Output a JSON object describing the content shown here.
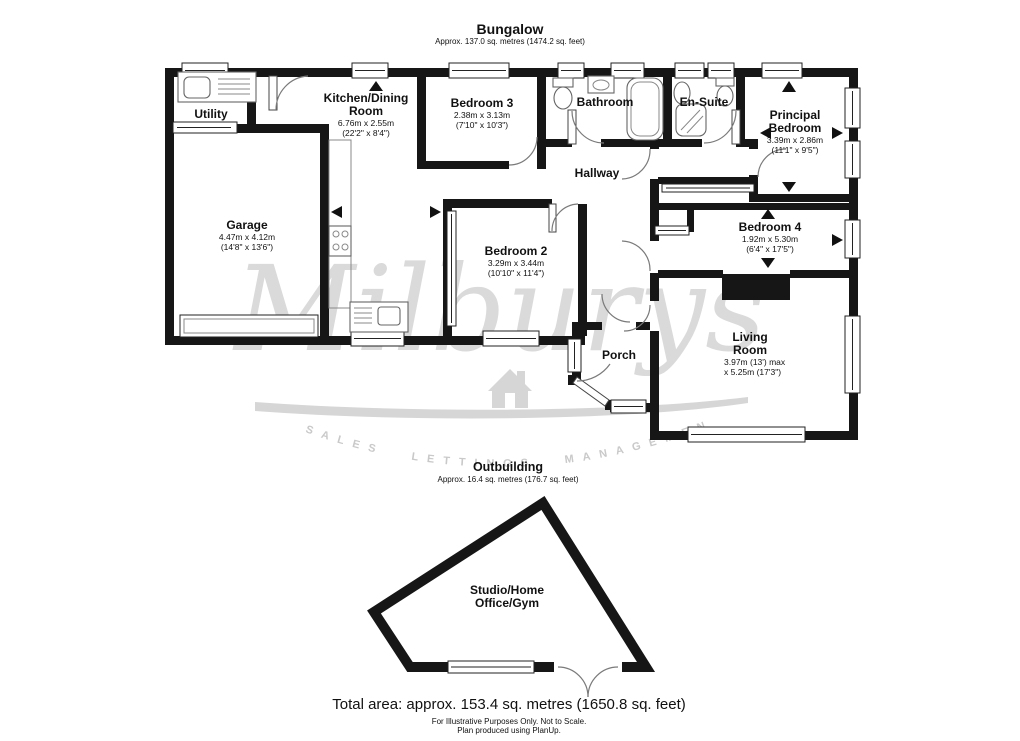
{
  "header": {
    "title": "Bungalow",
    "subtitle": "Approx. 137.0 sq. metres (1474.2 sq. feet)"
  },
  "outbuilding": {
    "title": "Outbuilding",
    "subtitle": "Approx. 16.4 sq. metres (176.7 sq. feet)"
  },
  "rooms": {
    "utility": {
      "name": "Utility"
    },
    "kitchen": {
      "name": "Kitchen/Dining Room",
      "metric": "6.76m x 2.55m",
      "imperial": "(22'2\" x 8'4\")"
    },
    "bedroom3": {
      "name": "Bedroom 3",
      "metric": "2.38m x 3.13m",
      "imperial": "(7'10\" x 10'3\")"
    },
    "bathroom": {
      "name": "Bathroom"
    },
    "ensuite": {
      "name": "En-Suite"
    },
    "principal": {
      "name": "Principal Bedroom",
      "metric": "3.39m x 2.86m",
      "imperial": "(11'1\" x 9'5\")"
    },
    "garage": {
      "name": "Garage",
      "metric": "4.47m x 4.12m",
      "imperial": "(14'8\" x 13'6\")"
    },
    "bedroom2": {
      "name": "Bedroom 2",
      "metric": "3.29m x 3.44m",
      "imperial": "(10'10\" x 11'4\")"
    },
    "hallway": {
      "name": "Hallway"
    },
    "bedroom4": {
      "name": "Bedroom 4",
      "metric": "1.92m x 5.30m",
      "imperial": "(6'4\" x 17'5\")"
    },
    "living": {
      "name": "Living Room",
      "metric": "3.97m (13') max",
      "imperial": "x 5.25m (17'3\")"
    },
    "porch": {
      "name": "Porch"
    },
    "studio": {
      "name": "Studio/Home Office/Gym"
    }
  },
  "watermark": {
    "name": "Milburys",
    "tagline": "SALES  LETTINGS  MANAGEMENT"
  },
  "footer": {
    "total": "Total area: approx. 153.4 sq. metres (1650.8 sq. feet)",
    "line1": "For Illustrative Purposes Only. Not to Scale.",
    "line2": "Plan produced using PlanUp."
  },
  "colors": {
    "wall": "#161616",
    "watermark": "#d6d6d6",
    "background": "#ffffff"
  }
}
